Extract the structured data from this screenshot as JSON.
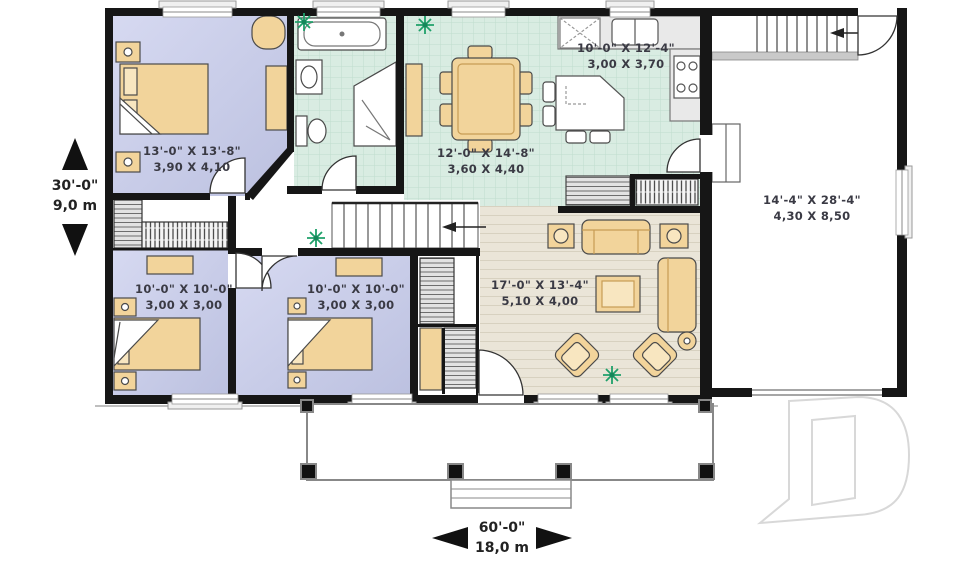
{
  "plan": {
    "rooms": {
      "master": {
        "imperial": "13'-0\" X 13'-8\"",
        "metric": "3,90 X 4,10"
      },
      "kitchen": {
        "imperial": "10'-0\" X 12'-4\"",
        "metric": "3,00 X 3,70"
      },
      "dining": {
        "imperial": "12'-0\" X 14'-8\"",
        "metric": "3,60 X 4,40"
      },
      "garage": {
        "imperial": "14'-4\" X 28'-4\"",
        "metric": "4,30 X 8,50"
      },
      "bedroom2": {
        "imperial": "10'-0\" X 10'-0\"",
        "metric": "3,00 X 3,00"
      },
      "bedroom3": {
        "imperial": "10'-0\" X 10'-0\"",
        "metric": "3,00 X 3,00"
      },
      "living": {
        "imperial": "17'-0\" X 13'-4\"",
        "metric": "5,10 X 4,00"
      }
    },
    "dimensions": {
      "depth_imperial": "30'-0\"",
      "depth_metric": "9,0 m",
      "width_imperial": "60'-0\"",
      "width_metric": "18,0 m"
    },
    "icons": [
      "arrow-up-icon",
      "arrow-down-icon",
      "arrow-left-icon",
      "arrow-right-icon",
      "plant-icon",
      "stair-direction-arrow",
      "watermark-d-logo"
    ],
    "colors": {
      "bedroom_floor": "#ccd1ec",
      "tile_floor": "#d9ece2",
      "wood_floor": "#eae5d8",
      "furniture": "#f2d49b",
      "wall": "#161616",
      "plant": "#1fa06a",
      "watermark": "#d8d8d8"
    }
  }
}
